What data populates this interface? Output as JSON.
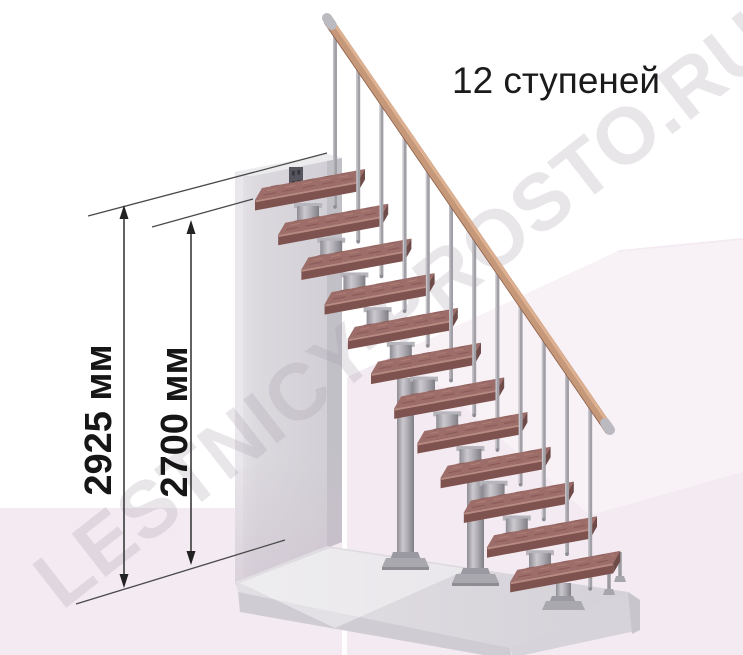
{
  "title": "12 ступеней",
  "watermark": "LESTNICY-PROSTO.RU",
  "dimensions": {
    "height_total": "2925 мм",
    "height_inner": "2700 мм"
  },
  "diagram": {
    "type": "modular-staircase-side-view",
    "steps_count": 12,
    "balusters_count": 12,
    "floor_columns": 3,
    "handrail": true,
    "colors": {
      "tread_top": "#9d6d69",
      "tread_streak_dark": "#8a5b58",
      "tread_streak_light": "#b28078",
      "tread_front": "#7e534f",
      "tread_side": "#6f4b49",
      "tread_nose": "#b88a81",
      "metal_light": "#c9c7cc",
      "metal_mid": "#a6a4ab",
      "metal_dark": "#85838a",
      "baluster": "#a2a0a7",
      "ball_joint": "#c9c7cd",
      "handrail_wood": "#c49878",
      "handrail_shadow": "#8a5a46",
      "handrail_highlight": "#dcb090",
      "handrail_cap": "#bcbac1",
      "wall_front": "#d8d6db",
      "wall_side": "#c2c0c7",
      "wall_top": "#ecebee",
      "bracket": "#56545c",
      "floor_top": "#d8d5dc",
      "floor_front": "#cfccd4",
      "floor_right": "#d7d3da",
      "background_tint": "#f4eaf2",
      "dimension_line": "#3a3a3a",
      "text": "#1b1b1b"
    }
  }
}
